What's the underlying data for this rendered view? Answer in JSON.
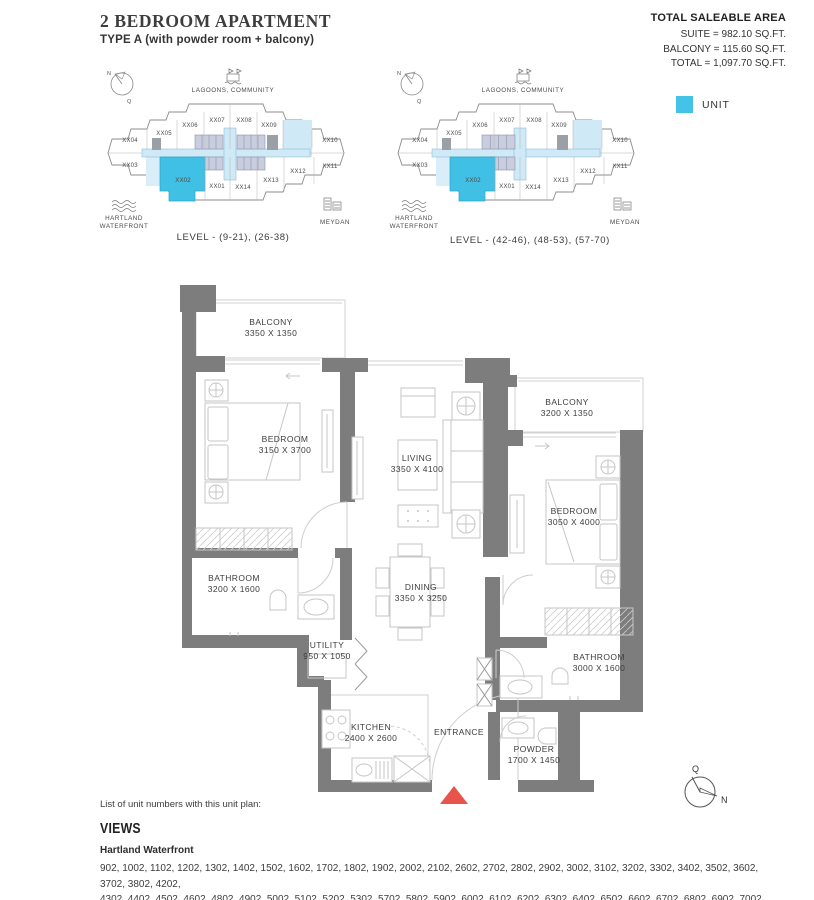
{
  "header": {
    "title": "2 BEDROOM APARTMENT",
    "subtitle": "TYPE A (with powder room + balcony)"
  },
  "area_summary": {
    "heading": "TOTAL SALEABLE AREA",
    "lines": [
      "SUITE = 982.10 SQ.FT.",
      "BALCONY = 115.60 SQ.FT.",
      "TOTAL = 1,097.70 SQ.FT."
    ]
  },
  "legend": {
    "label": "UNIT",
    "color": "#44c3e8"
  },
  "colors": {
    "unit_highlight": "#3fc0e4",
    "corridor": "#cfe9f6",
    "pale_unit": "#d9eef8",
    "core_block": "#c9cdde",
    "wall": "#7d7d7d",
    "entrance_marker": "#e8544b"
  },
  "key_plans": [
    {
      "caption": "LEVEL - (9-21), (26-38)",
      "top_label": "LAGOONS, COMMUNITY",
      "left_label_lines": [
        "HARTLAND",
        "WATERFRONT"
      ],
      "right_label": "MEYDAN",
      "compass": {
        "n": "N",
        "q": "Q"
      },
      "highlighted_unit": "XX02",
      "units_top": [
        "XX04",
        "XX05",
        "XX06",
        "XX07",
        "XX08",
        "XX09",
        "XX10"
      ],
      "units_bottom": [
        "XX03",
        "XX02",
        "XX01",
        "XX14",
        "XX13",
        "XX12",
        "XX11"
      ]
    },
    {
      "caption": "LEVEL - (42-46), (48-53), (57-70)",
      "top_label": "LAGOONS, COMMUNITY",
      "left_label_lines": [
        "HARTLAND",
        "WATERFRONT"
      ],
      "right_label": "MEYDAN",
      "compass": {
        "n": "N",
        "q": "Q"
      },
      "highlighted_unit": "XX02",
      "units_top": [
        "XX04",
        "XX05",
        "XX06",
        "XX07",
        "XX08",
        "XX09",
        "XX10"
      ],
      "units_bottom": [
        "XX03",
        "XX02",
        "XX01",
        "XX14",
        "XX13",
        "XX12",
        "XX11"
      ]
    }
  ],
  "floor_plan": {
    "rooms": [
      {
        "name": "BALCONY",
        "dims": "3350 X 1350"
      },
      {
        "name": "BEDROOM",
        "dims": "3150 X 3700"
      },
      {
        "name": "LIVING",
        "dims": "3350 X 4100"
      },
      {
        "name": "BALCONY",
        "dims": "3200 X 1350"
      },
      {
        "name": "BEDROOM",
        "dims": "3050 X 4000"
      },
      {
        "name": "BATHROOM",
        "dims": "3200 X 1600"
      },
      {
        "name": "DINING",
        "dims": "3350 X 3250"
      },
      {
        "name": "UTILITY",
        "dims": "950 X 1050"
      },
      {
        "name": "KITCHEN",
        "dims": "2400 X 2600"
      },
      {
        "name": "ENTRANCE",
        "dims": ""
      },
      {
        "name": "POWDER",
        "dims": "1700 X 1450"
      },
      {
        "name": "BATHROOM",
        "dims": "3000 X 1600"
      }
    ]
  },
  "footer": {
    "list_label": "List of unit numbers with this unit plan:",
    "views_heading": "VIEWS",
    "view_name": "Hartland Waterfront",
    "unit_number_lines": [
      "902, 1002, 1102, 1202, 1302, 1402, 1502, 1602, 1702, 1802, 1902, 2002, 2102, 2602, 2702, 2802, 2902, 3002, 3102, 3202, 3302, 3402, 3502, 3602, 3702, 3802, 4202,",
      "4302, 4402, 4502, 4602, 4802, 4902, 5002, 5102, 5202, 5302, 5702, 5802, 5902, 6002, 6102, 6202, 6302, 6402, 6502, 6602, 6702, 6802, 6902, 7002"
    ],
    "compass": {
      "top": "Q",
      "right": "N"
    }
  }
}
